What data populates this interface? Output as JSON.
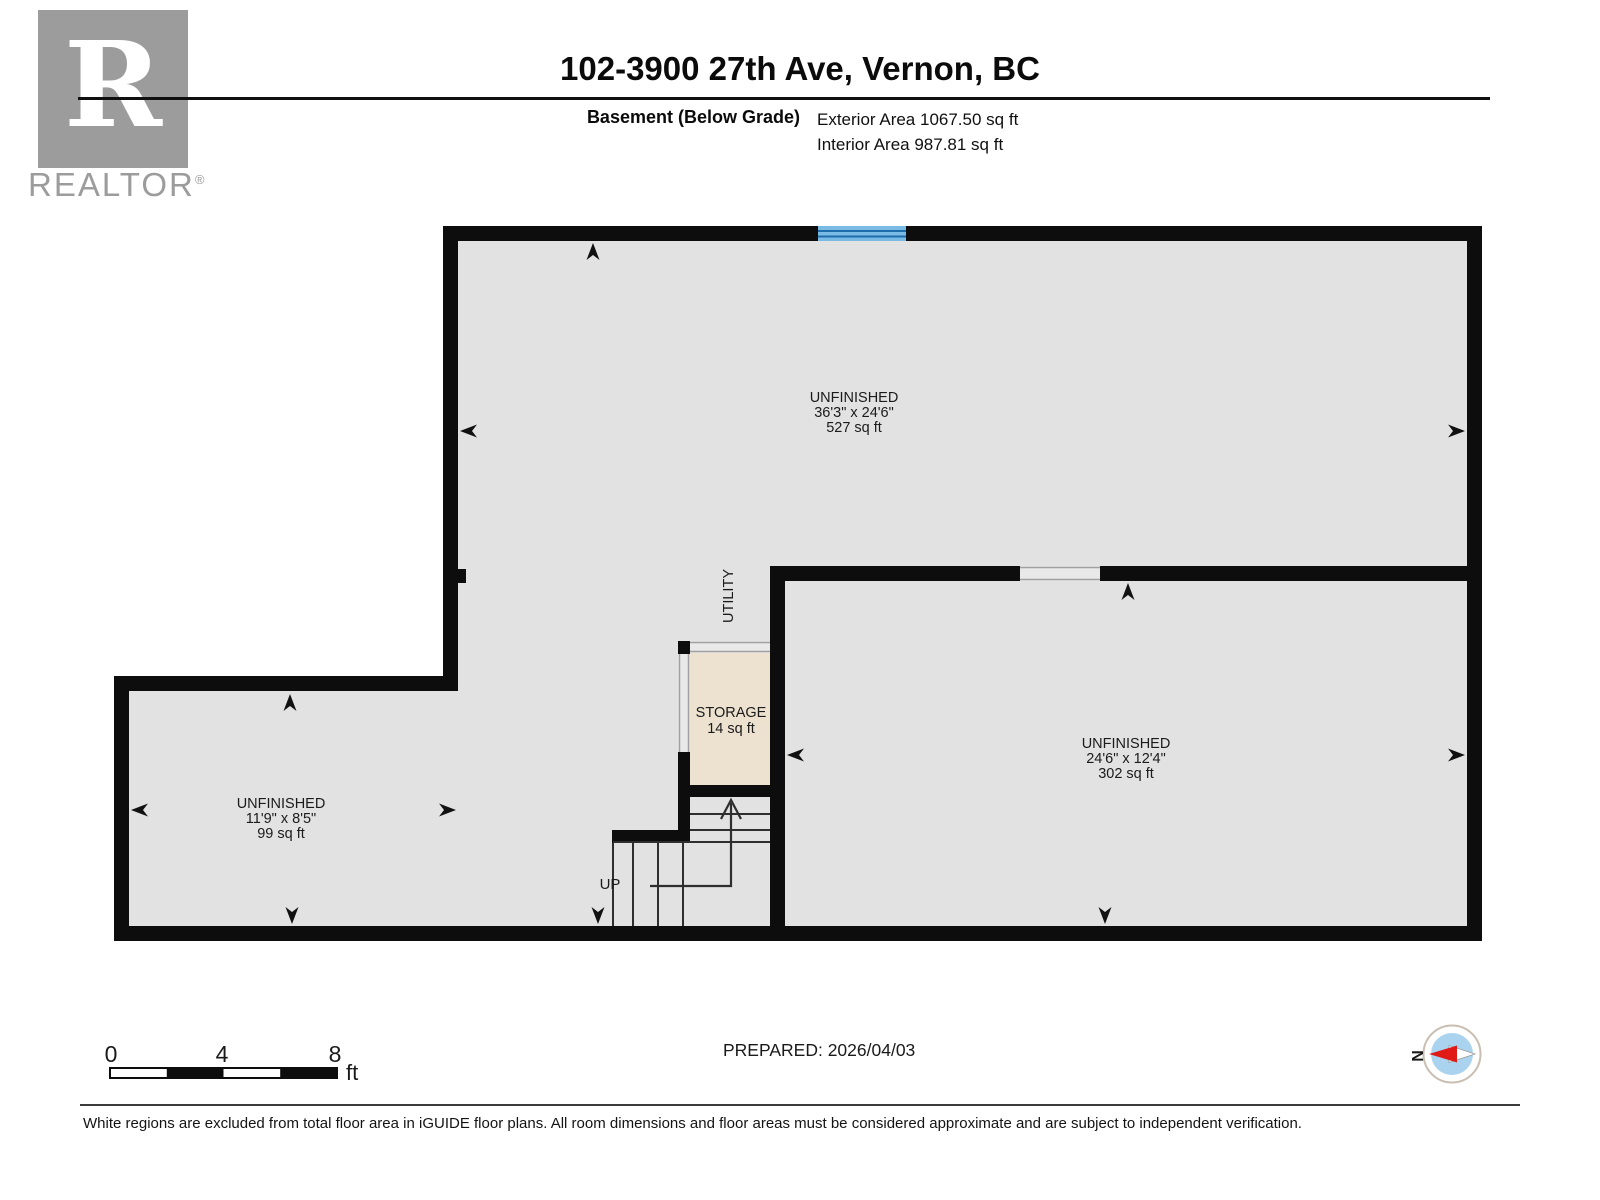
{
  "header": {
    "logo_letter": "R",
    "logo_brand": "REALTOR",
    "logo_registered": "®",
    "title": "102-3900 27th Ave, Vernon, BC",
    "floor_label": "Basement (Below Grade)",
    "exterior_area": "Exterior Area 1067.50 sq ft",
    "interior_area": "Interior Area 987.81 sq ft"
  },
  "plan": {
    "rooms": [
      {
        "name": "UNFINISHED",
        "dims": "36'3\" x 24'6\"",
        "area": "527 sq ft"
      },
      {
        "name": "UNFINISHED",
        "dims": "24'6\" x 12'4\"",
        "area": "302 sq ft"
      },
      {
        "name": "UNFINISHED",
        "dims": "11'9\" x 8'5\"",
        "area": "99 sq ft"
      },
      {
        "name": "STORAGE",
        "area": "14 sq ft"
      },
      {
        "name": "UTILITY"
      }
    ],
    "stairs": {
      "label": "UP"
    }
  },
  "scale_bar": {
    "tick0": "0",
    "tick1": "4",
    "tick2": "8",
    "unit": "ft"
  },
  "footer": {
    "prepared": "PREPARED: 2026/04/03",
    "compass_north_label": "N",
    "disclaimer": "White regions are excluded from total floor area in iGUIDE floor plans. All room dimensions and floor areas must be considered approximate and are subject to independent verification."
  },
  "colors": {
    "wall": "#0d0d0d",
    "floor": "#e2e2e2",
    "storage_floor": "#ece2cf",
    "opening": "#e9e9e9",
    "window_blue": "#7abbe5",
    "window_stripe": "#1d6da9",
    "compass_blue": "#a9d3ee",
    "compass_red": "#e01b17",
    "logo_gray": "#9c9c9c"
  }
}
